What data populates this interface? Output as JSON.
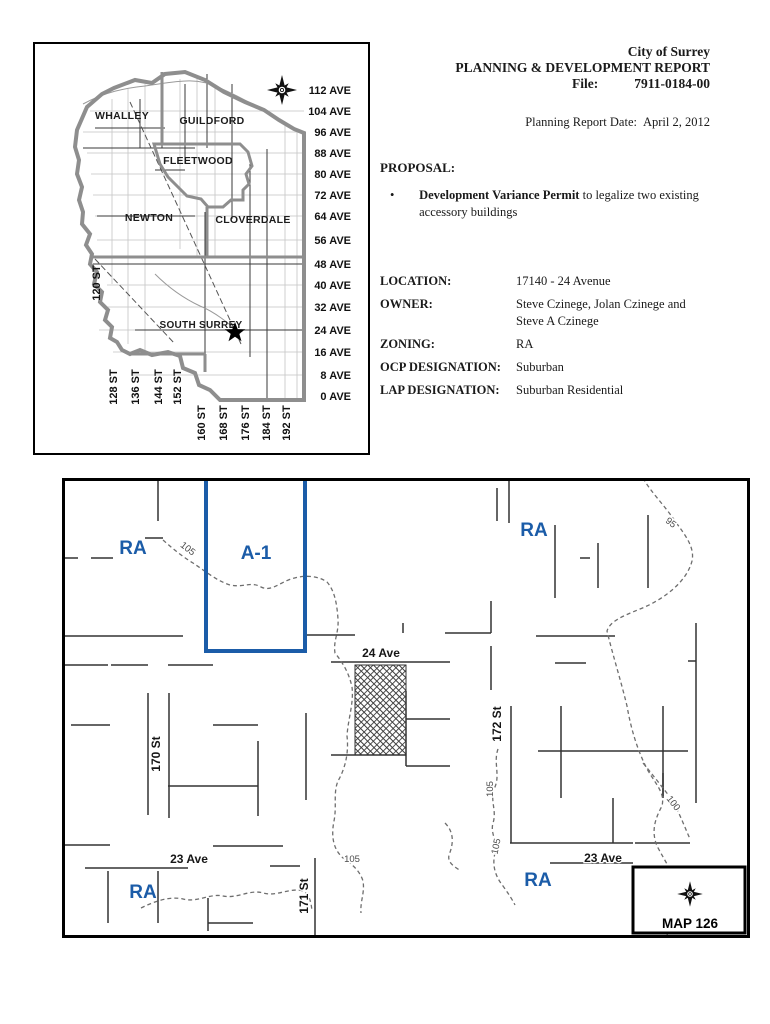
{
  "accent": "#1b5ca8",
  "report": {
    "city": "City of Surrey",
    "title": "PLANNING & DEVELOPMENT REPORT",
    "file_label": "File:",
    "file_number": "7911-0184-00",
    "date_label": "Planning Report Date:",
    "date_value": "April 2, 2012",
    "proposal_heading": "PROPOSAL:",
    "bullet_glyph": "•",
    "proposal_bullet_bold": "Development Variance Permit",
    "proposal_bullet_rest": " to legalize two existing accessory buildings",
    "fields": [
      {
        "label": "LOCATION:",
        "value": "17140 - 24 Avenue"
      },
      {
        "label": "OWNER:",
        "value": "Steve Czinege, Jolan Czinege and Steve A Czinege"
      },
      {
        "label": "ZONING:",
        "value": "RA"
      },
      {
        "label": "OCP DESIGNATION:",
        "value": "Suburban"
      },
      {
        "label": "LAP DESIGNATION:",
        "value": "Suburban Residential"
      }
    ]
  },
  "overview_map": {
    "regions": {
      "whalley": "WHALLEY",
      "guildford": "GUILDFORD",
      "fleetwood": "FLEETWOOD",
      "newton": "NEWTON",
      "cloverdale": "CLOVERDALE",
      "south_surrey": "SOUTH SURREY"
    },
    "ave_labels": [
      "112 AVE",
      "104 AVE",
      "96 AVE",
      "88 AVE",
      "80 AVE",
      "72 AVE",
      "64 AVE",
      "56 AVE",
      "48 AVE",
      "40 AVE",
      "32 AVE",
      "24 AVE",
      "16 AVE",
      "8 AVE",
      "0 AVE"
    ],
    "st_labels": [
      "120 ST",
      "128 ST",
      "136 ST",
      "144 ST",
      "152 ST",
      "160 ST",
      "168 ST",
      "176 ST",
      "184 ST",
      "192 ST"
    ]
  },
  "zoning_map": {
    "zones": {
      "ra_nw": "RA",
      "a1": "A-1",
      "ra_ne": "RA",
      "ra_sw": "RA",
      "ra_se": "RA"
    },
    "streets": {
      "st_170": "170 St",
      "st_171": "171 St",
      "st_172": "172 St",
      "ave_24": "24 Ave",
      "ave_23_w": "23 Ave",
      "ave_23_e": "23 Ave"
    },
    "contours": {
      "c105_nw": "105",
      "c95_ne": "95",
      "c105_s": "105",
      "c105_e1": "105",
      "c105_e2": "105",
      "c100_se": "100"
    },
    "map_ref": "MAP 126"
  }
}
